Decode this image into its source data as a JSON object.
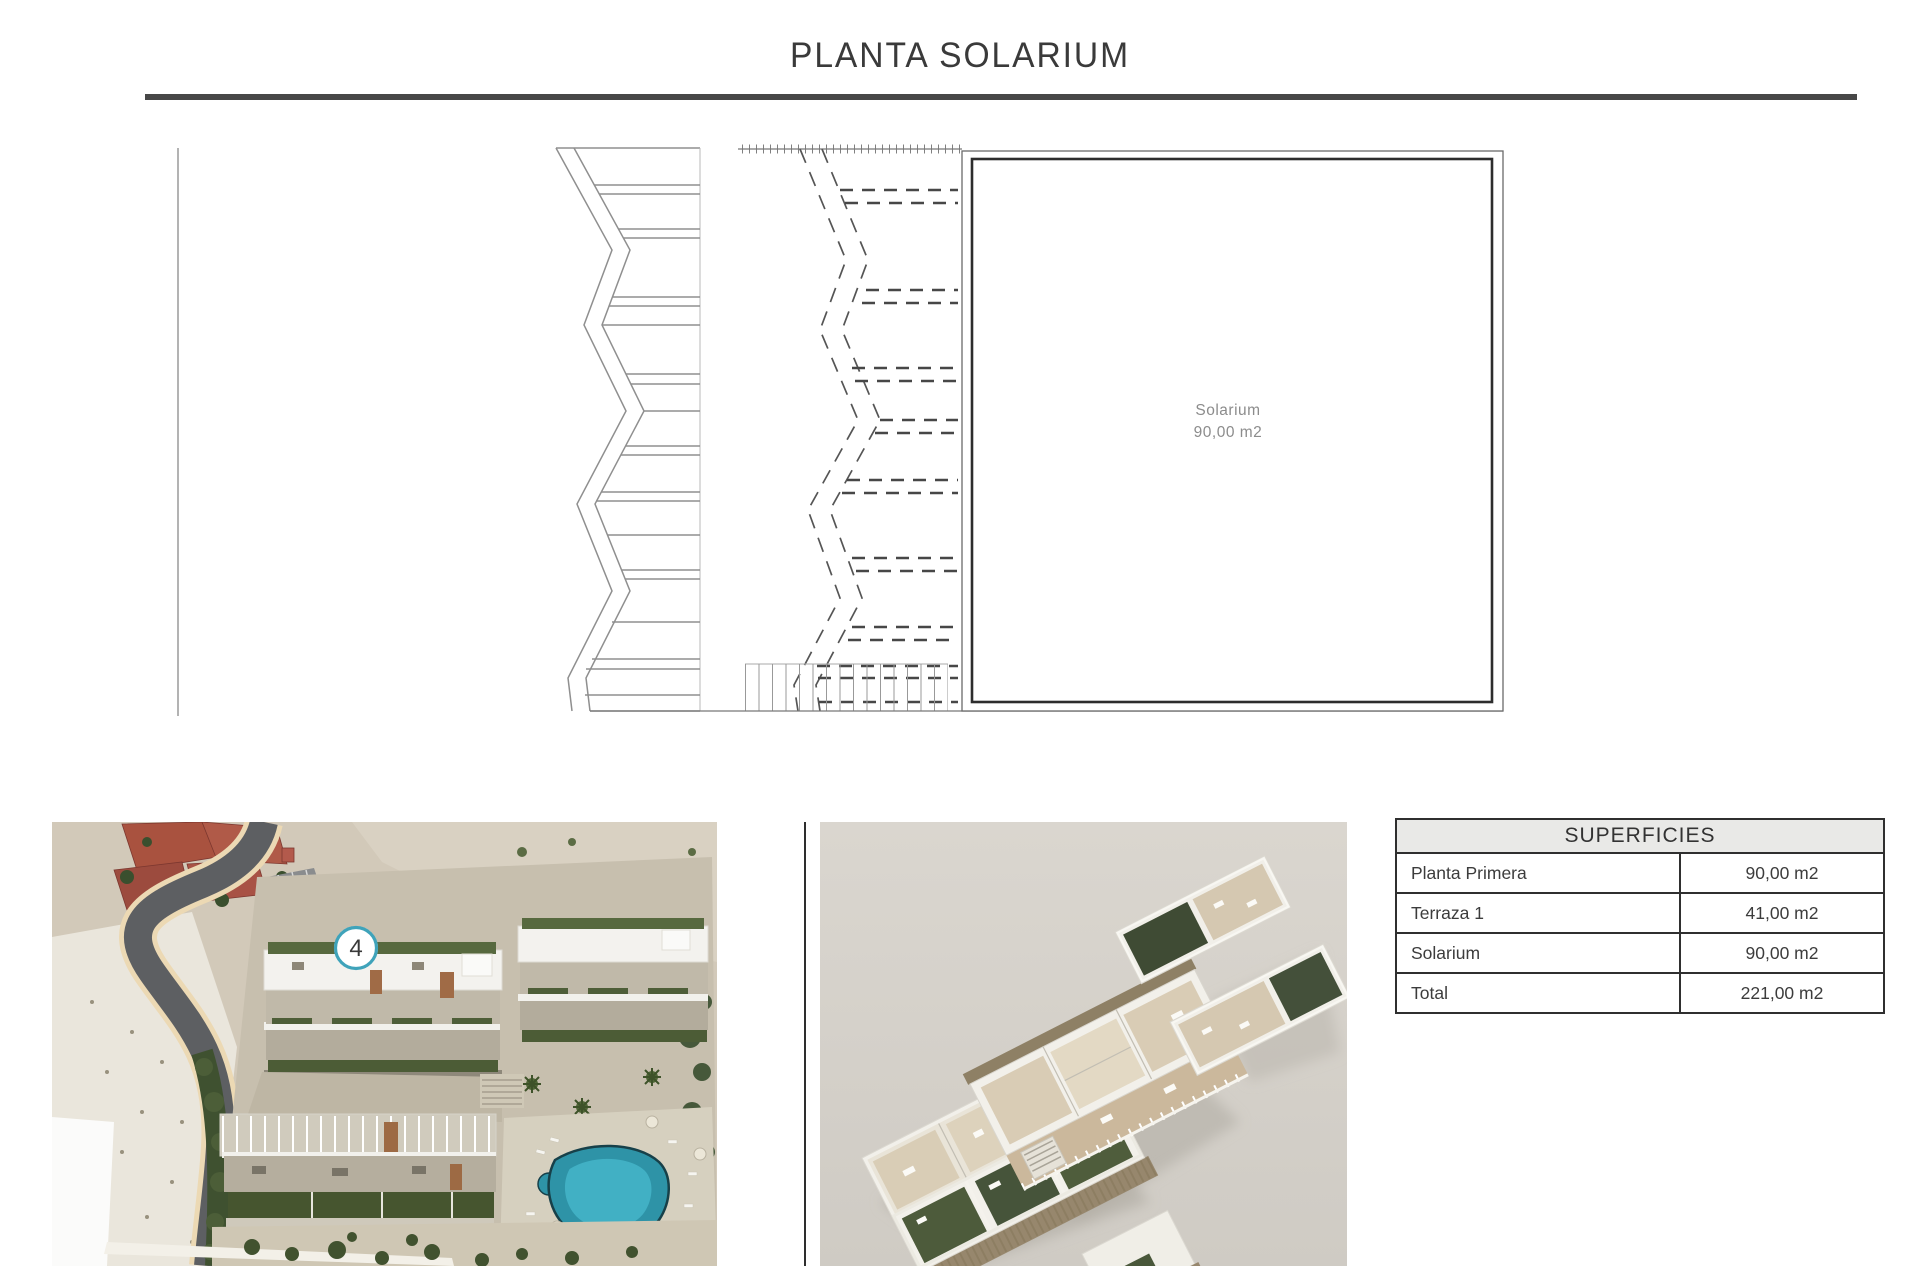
{
  "page": {
    "title": "PLANTA SOLARIUM"
  },
  "plan": {
    "room_label": "Solarium",
    "room_area": "90,00 m2"
  },
  "aerial": {
    "badge": "4"
  },
  "table": {
    "header": "SUPERFICIES",
    "rows": [
      {
        "label": "Planta Primera",
        "value": "90,00 m2"
      },
      {
        "label": "Terraza 1",
        "value": "41,00 m2"
      },
      {
        "label": "Solarium",
        "value": "90,00 m2"
      },
      {
        "label": "Total",
        "value": "221,00 m2"
      }
    ]
  },
  "colors": {
    "badge_ring": "#3FA3BA",
    "pool": "#2E93A7",
    "table_header_bg": "#E9E9E7",
    "rule": "#474747"
  }
}
